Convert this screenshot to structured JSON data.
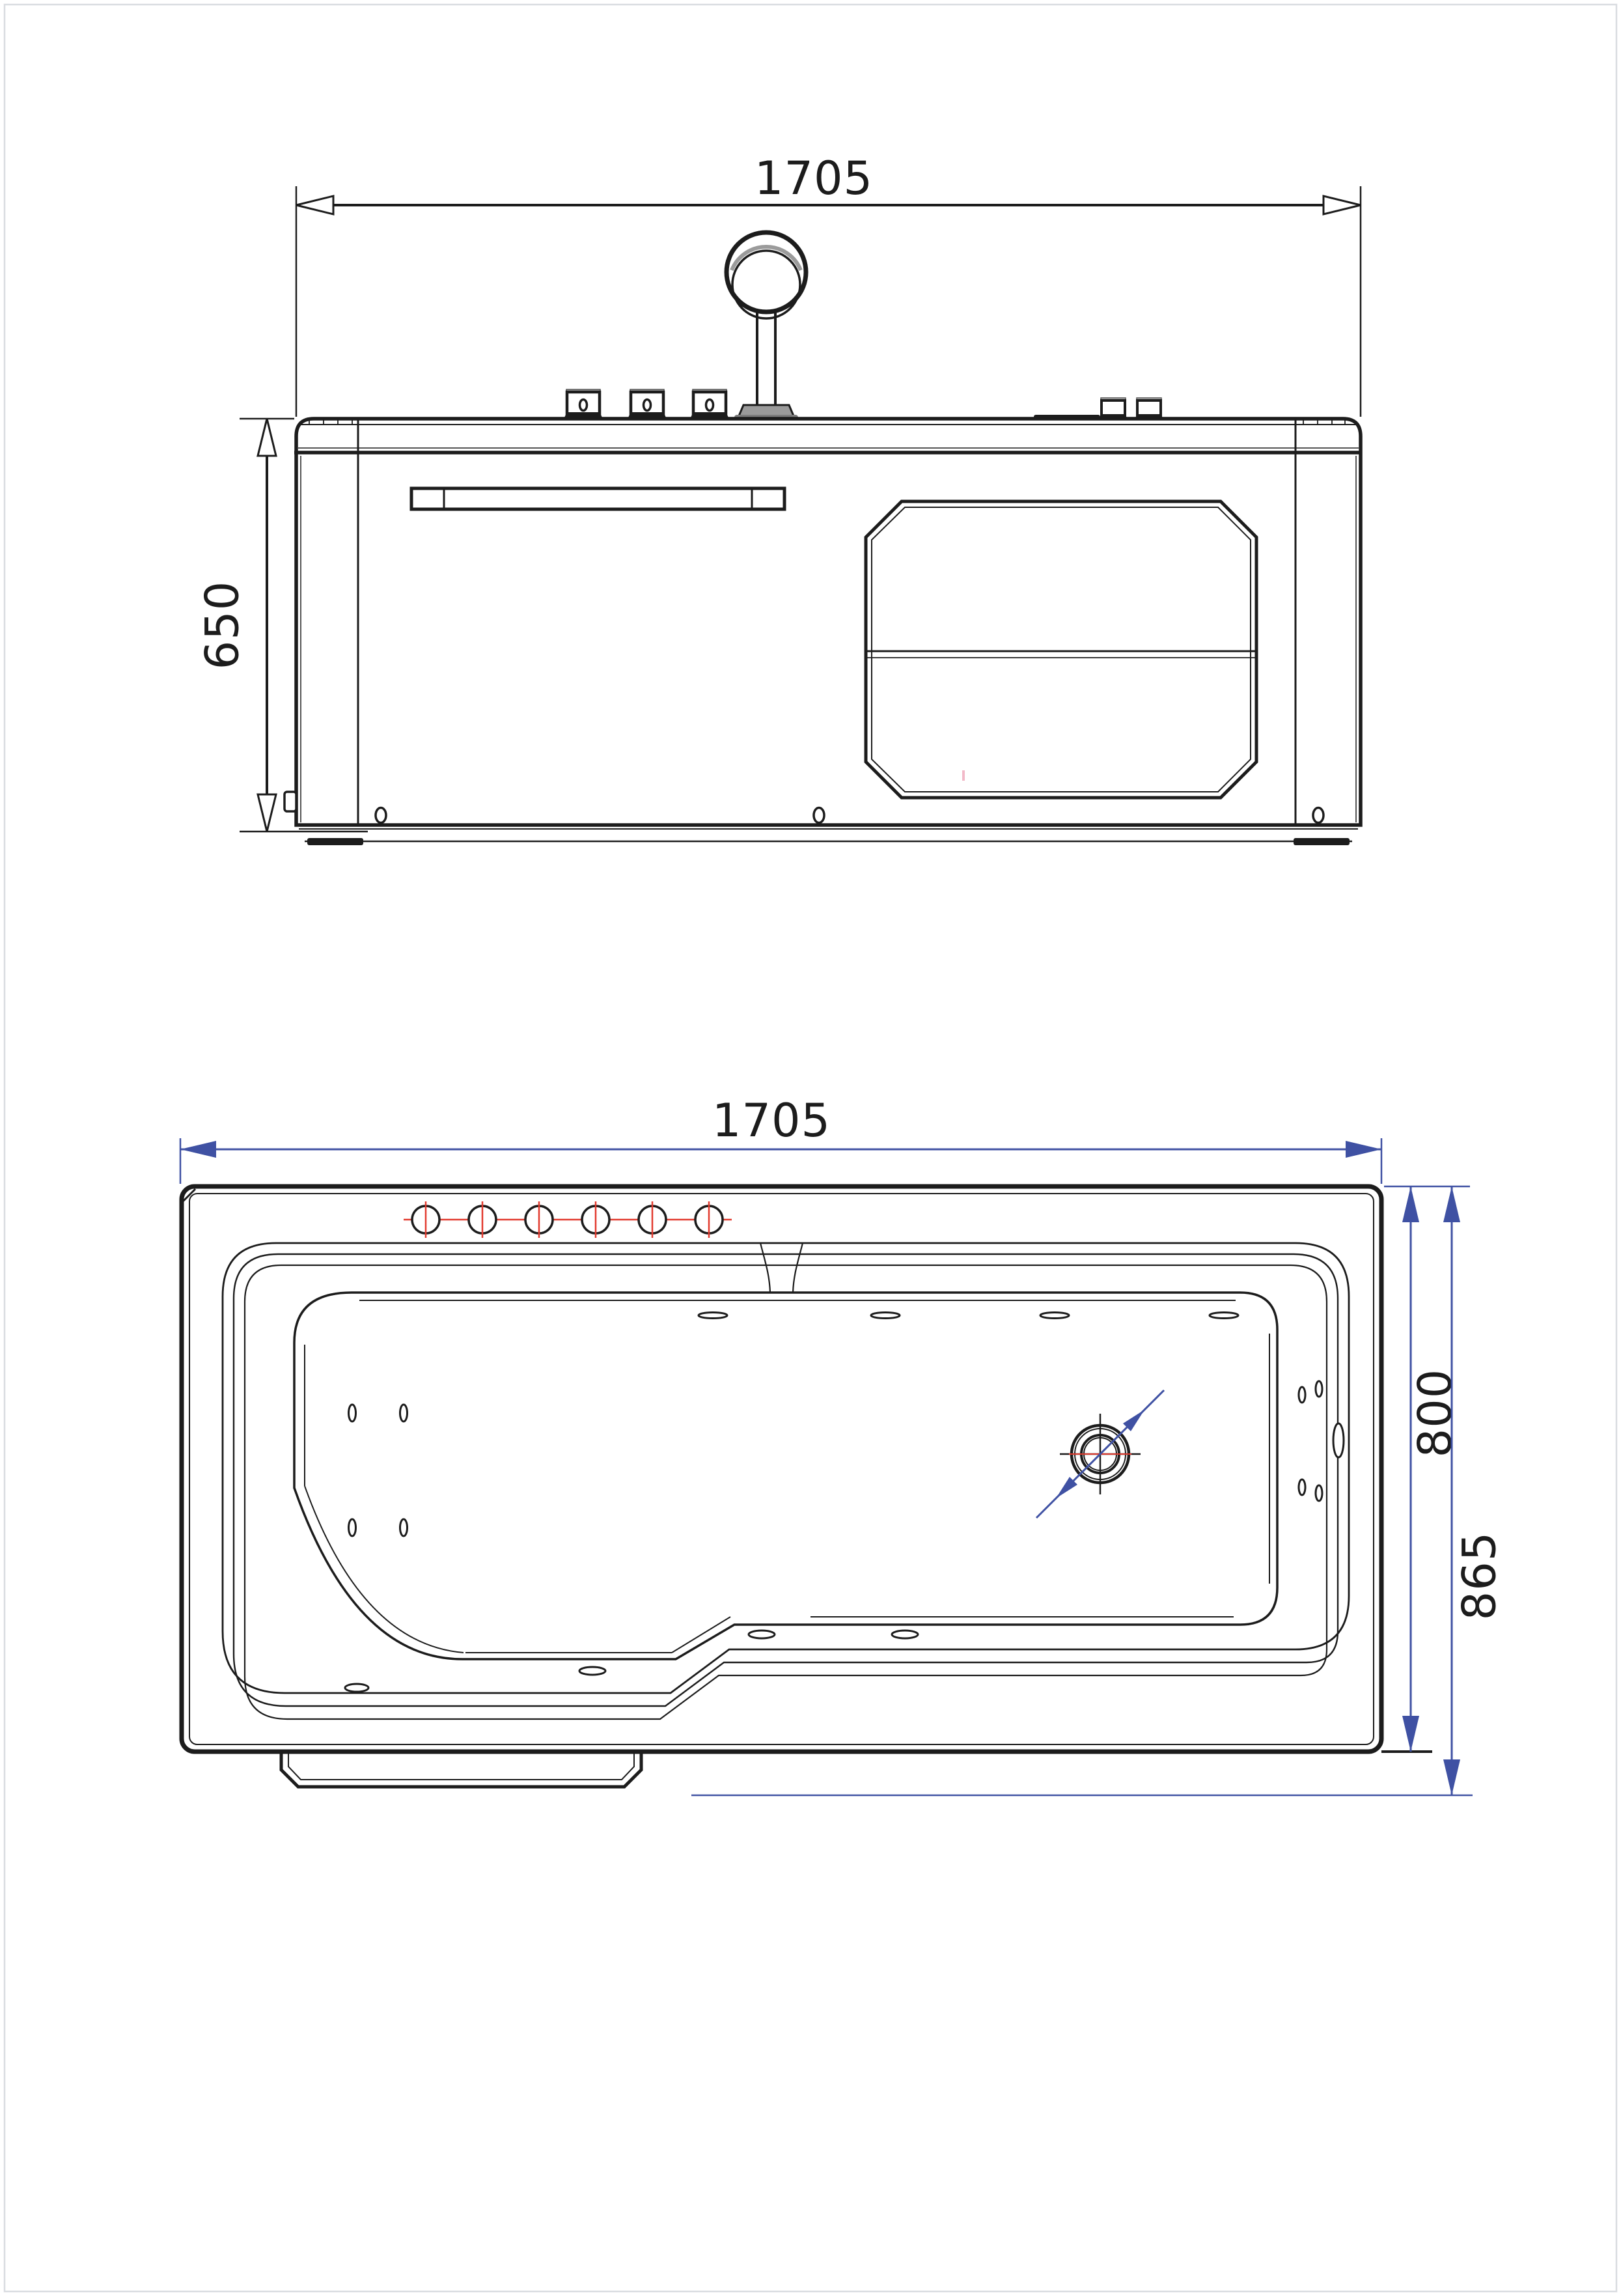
{
  "drawing": {
    "title_implicit": "bathtub two-view dimensioned drawing",
    "front_view": {
      "width_label": "1705",
      "height_label": "650"
    },
    "plan_view": {
      "width_label": "1705",
      "inner_depth_label": "800",
      "overall_depth_label": "865"
    }
  },
  "colors": {
    "ink": "#1c1c1c",
    "dim_blue": "#3f51a3",
    "jet_red": "#e23a2e",
    "metal_gray": "#9b9b9b",
    "light_gray": "#b3b3b3",
    "page_border": "#d9dde1",
    "artifact_pink": "#f2b9c8"
  }
}
